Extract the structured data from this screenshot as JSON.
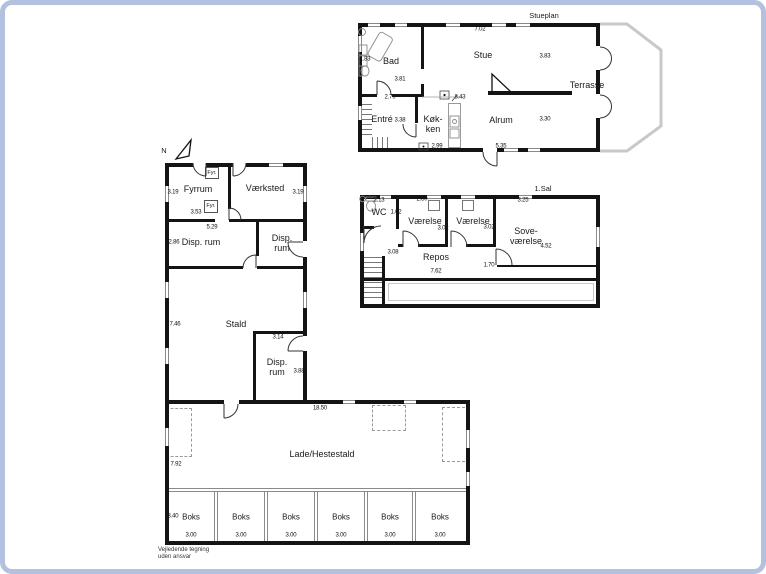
{
  "stueplan": {
    "title": "Stueplan",
    "rooms": {
      "bad": "Bad",
      "stue": "Stue",
      "entre": "Entré",
      "koekken": "Køk-\nken",
      "alrum": "Alrum",
      "terrasse": "Terrasse"
    },
    "dims": [
      "7.02",
      "1.83",
      "3.81",
      "3.83",
      "2.79",
      "8.43",
      "3.38",
      "2.99",
      "5.35",
      "3.30"
    ]
  },
  "foerste_sal": {
    "title": "1.Sal",
    "rooms": {
      "wc": "WC",
      "vaerelse1": "Værelse",
      "vaerelse2": "Værelse",
      "sovevaerelse": "Sove-\nværelse",
      "repos": "Repos"
    },
    "dims": [
      "2.13",
      "1.62",
      "2.80",
      "3.02",
      "3.02",
      "3.25",
      "4.52",
      "3.08",
      "1.70",
      "7.62"
    ]
  },
  "udbygning": {
    "north_label": "N",
    "rooms": {
      "fyrrum": "Fyrrum",
      "vaerksted": "Værksted",
      "fyr1": "Fyr.",
      "fyr2": "Fyr.",
      "disp1": "Disp. rum",
      "disp2": "Disp.\nrum",
      "stald": "Stald",
      "disp3": "Disp.\nrum",
      "lade": "Lade/Hestestald"
    },
    "dims": [
      "3.19",
      "3.19",
      "3.53",
      "5.29",
      "2.86",
      "7.46",
      "3.14",
      "3.88",
      "18.50",
      "7.92",
      "3.40"
    ],
    "boks": [
      "Boks",
      "Boks",
      "Boks",
      "Boks",
      "Boks",
      "Boks"
    ],
    "boks_dims": [
      "3.00",
      "3.00",
      "3.00",
      "3.00",
      "3.00",
      "3.00"
    ]
  },
  "disclaimer": "Vejledende tegning\nuden ansvar",
  "colors": {
    "frame": "#b3c1e0",
    "wall": "#141414",
    "terrace_outline": "#c8c8c8"
  }
}
